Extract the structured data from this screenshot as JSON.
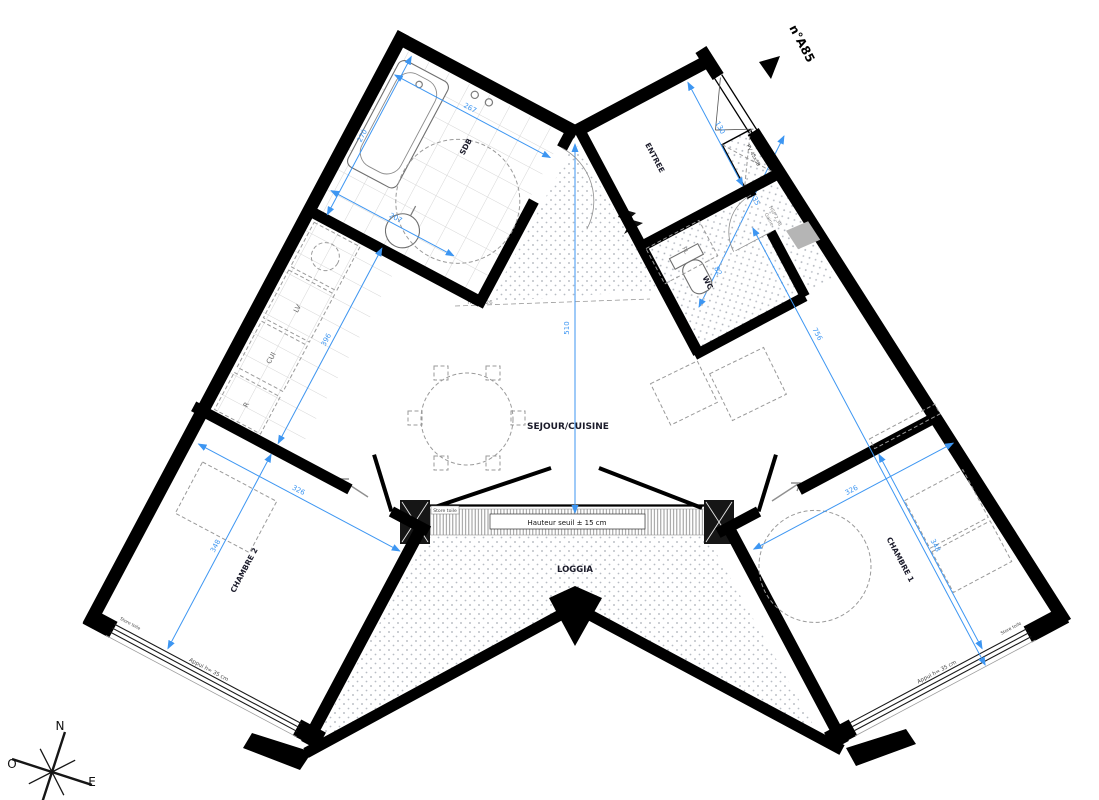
{
  "unit": {
    "number": "n°A85"
  },
  "compass": {
    "n": "N",
    "o": "O",
    "e": "E"
  },
  "rooms": {
    "sdb": "SDB",
    "entree": "ENTREE",
    "wc": "WC",
    "pl": "PL",
    "sejour": "SEJOUR/CUISINE",
    "chambre1": "CHAMBRE 1",
    "chambre2": "CHAMBRE 2",
    "loggia": "LOGGIA"
  },
  "kitchen": {
    "cui": "CUI",
    "lv": "LV",
    "r": "R"
  },
  "annotations": {
    "hauteur_seuil": "Hauteur seuil ± 15 cm",
    "store_toile": "Store toile",
    "appui": "Appui h= 35 cm",
    "soffite_1": "Soffite",
    "soffite_2": "HSP  2,26",
    "gaine_1": "Gaine",
    "gaine_2": "HSP 2,38",
    "pv": "PV 45x58"
  },
  "dimensions": {
    "sdb_w": "267",
    "sdb_d": "270",
    "sdb_inner": "207",
    "kitchen_len": "396",
    "sejour_h": "510",
    "entree_w": "130",
    "hall_a": "135",
    "hall_b": "82",
    "wing_len": "756",
    "ch2_w": "326",
    "ch2_d": "348",
    "ch1_w": "326",
    "ch1_d": "348"
  },
  "colors": {
    "dim": "#3d96f2",
    "wall": "#000000",
    "label": "#1b1b2a",
    "annotation": "#8a8a8a"
  }
}
